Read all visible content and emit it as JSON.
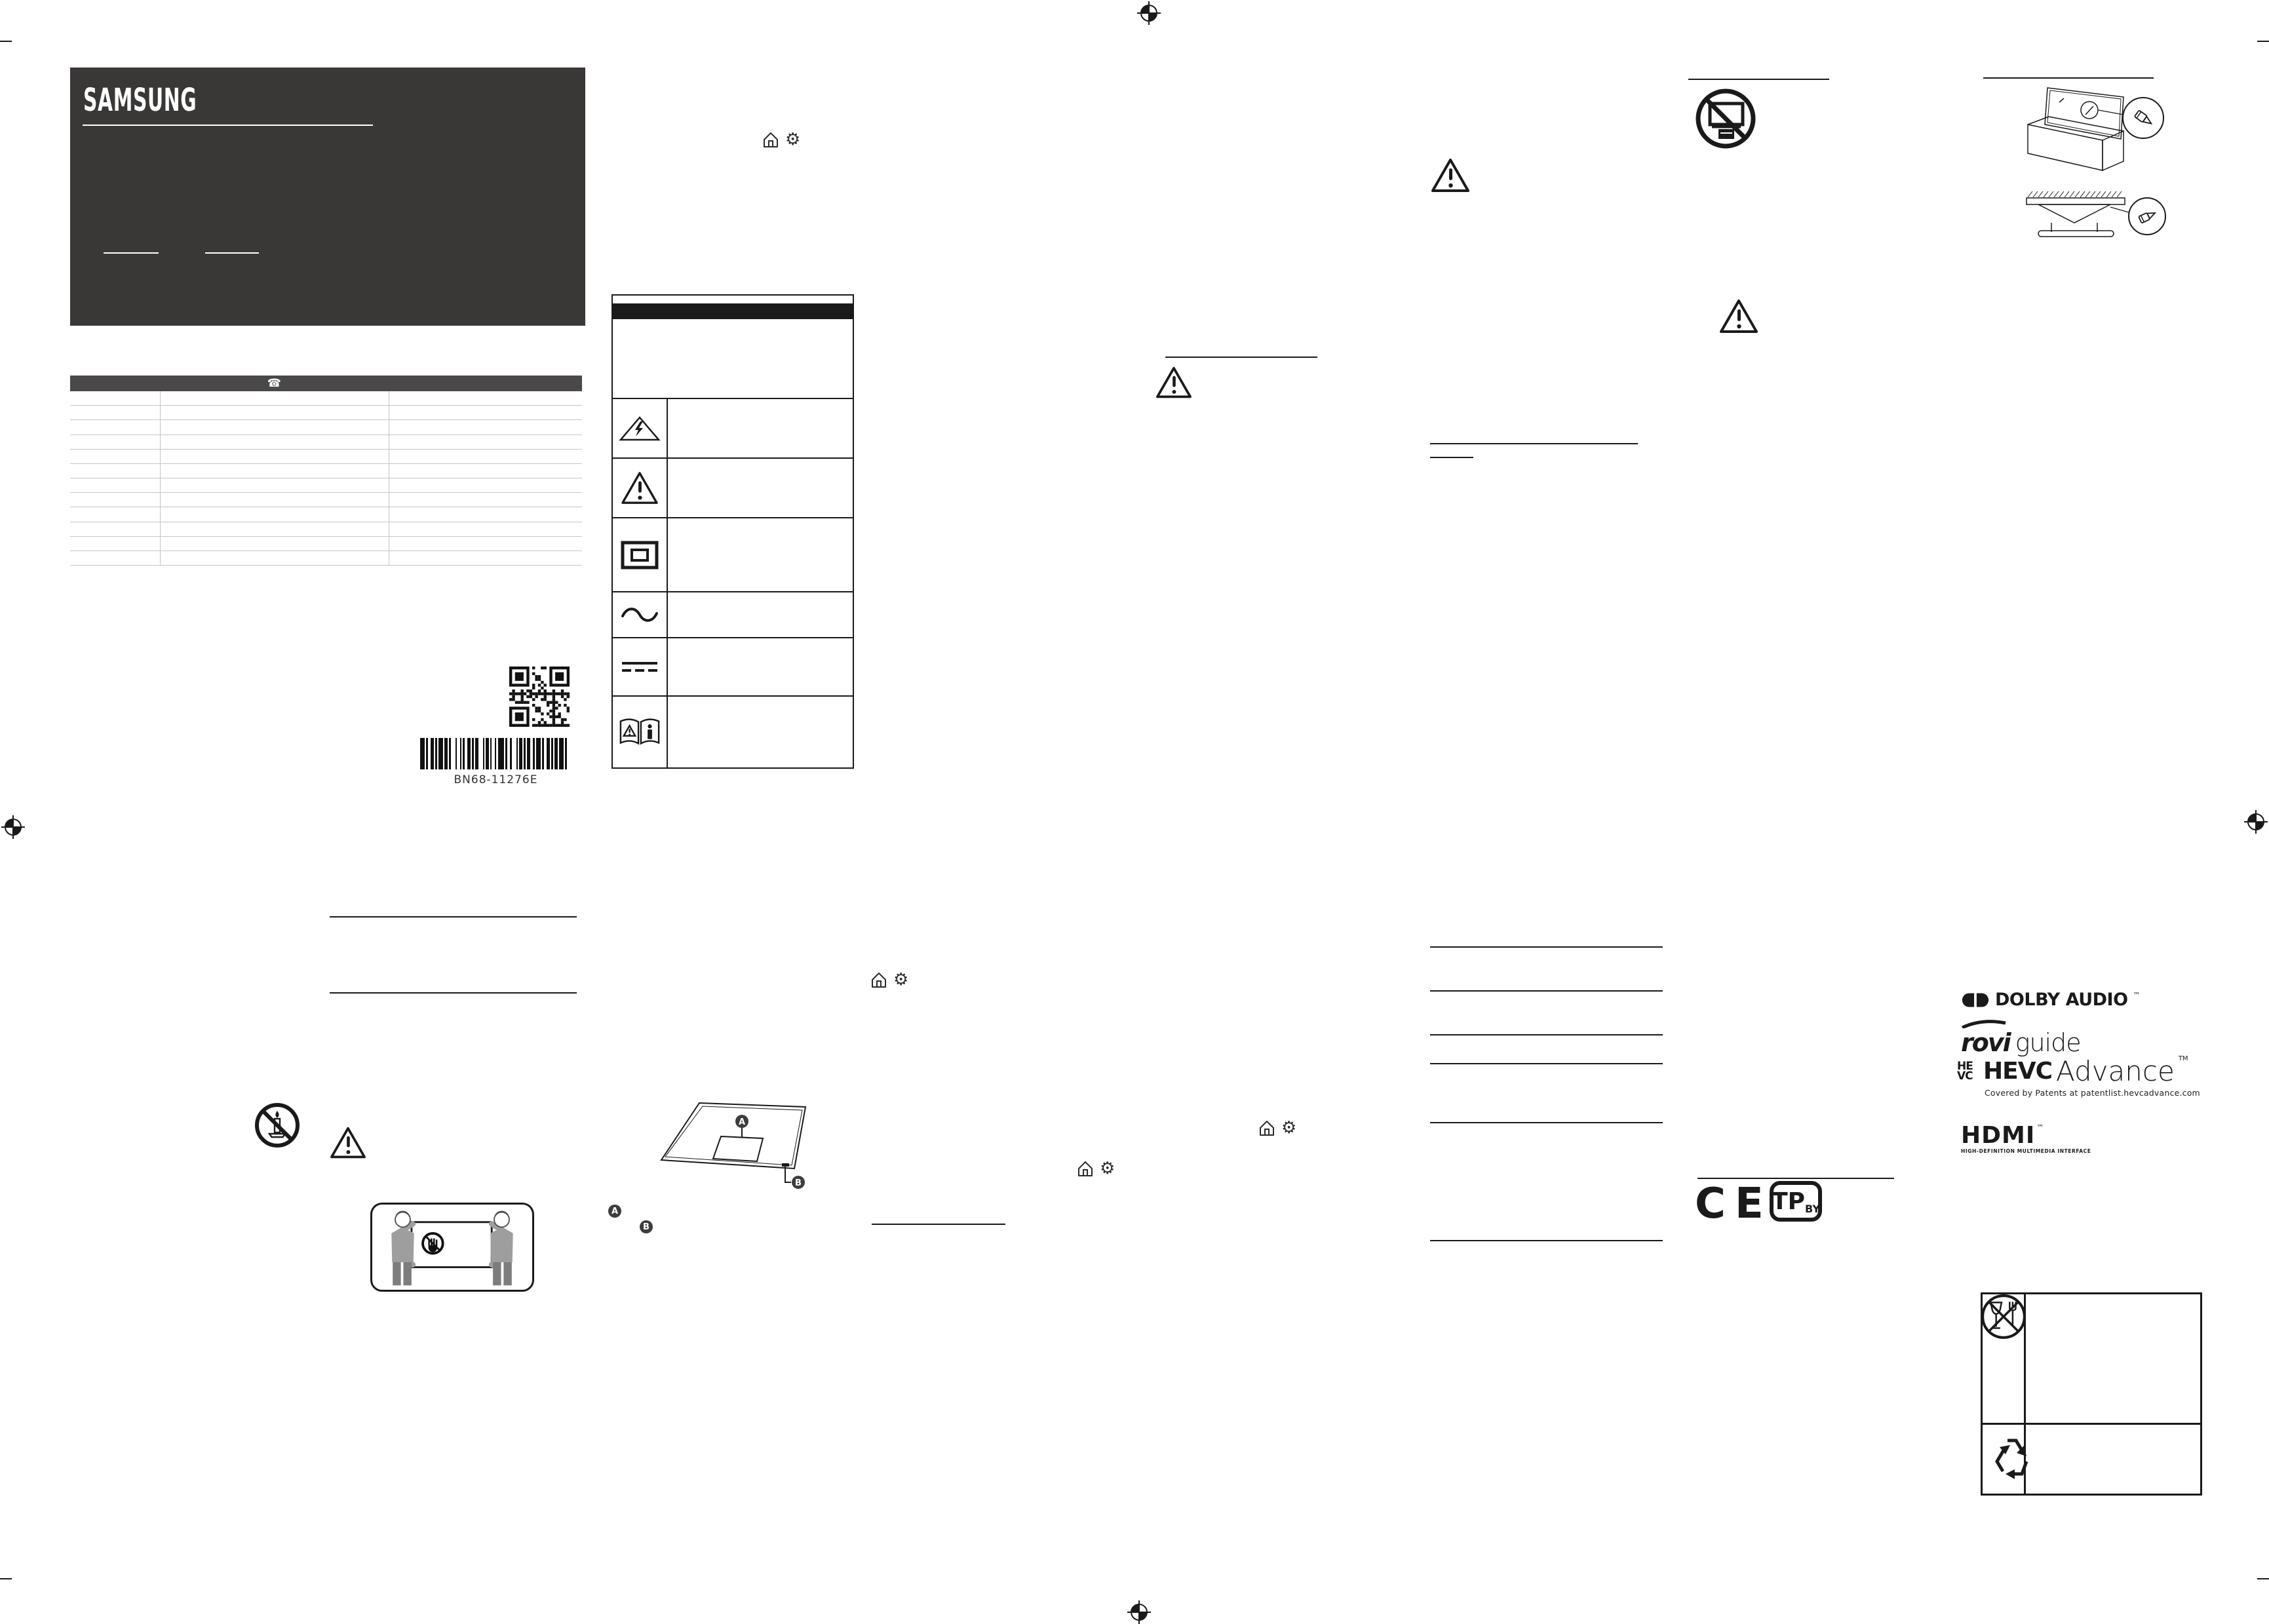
{
  "page": {
    "background": "#ffffff",
    "ink": "#1a1a1a",
    "dark_panel": "#3a3837",
    "table_header": "#4a4848",
    "hairline": "#c6c6c6"
  },
  "brand_card": {
    "brand": "SAMSUNG"
  },
  "glyphs": {
    "telephone": "☎",
    "gear": "⚙"
  },
  "contact_table": {
    "row_count": 12
  },
  "codes": {
    "barcode_label": "BN68-11276E"
  },
  "symbol_table": {
    "icon_names": [
      "high-voltage-warning-icon",
      "caution-warning-icon",
      "class2-double-insulation-icon",
      "ac-voltage-icon",
      "dc-voltage-icon",
      "read-instruction-manual-icon"
    ]
  },
  "callouts": {
    "a": "A",
    "b": "B"
  },
  "marks": {
    "ce": "CE",
    "tp": "TP",
    "tp_region": "BY"
  },
  "logos": {
    "dolby_word": "DOLBY AUDIO",
    "dolby_tm": "™",
    "rovi_word": "rovi",
    "rovi_sub": "guide",
    "hevc_stack_top": "HE",
    "hevc_stack_bottom": "VC",
    "hevc_word_bold": "HEVC",
    "hevc_word_light": "Advance",
    "hevc_tm": "TM",
    "hevc_patent_line": "Covered by Patents at patentlist.hevcadvance.com",
    "hdmi_word": "HDMI",
    "hdmi_tm": "™",
    "hdmi_sub": "HIGH-DEFINITION MULTIMEDIA INTERFACE"
  }
}
